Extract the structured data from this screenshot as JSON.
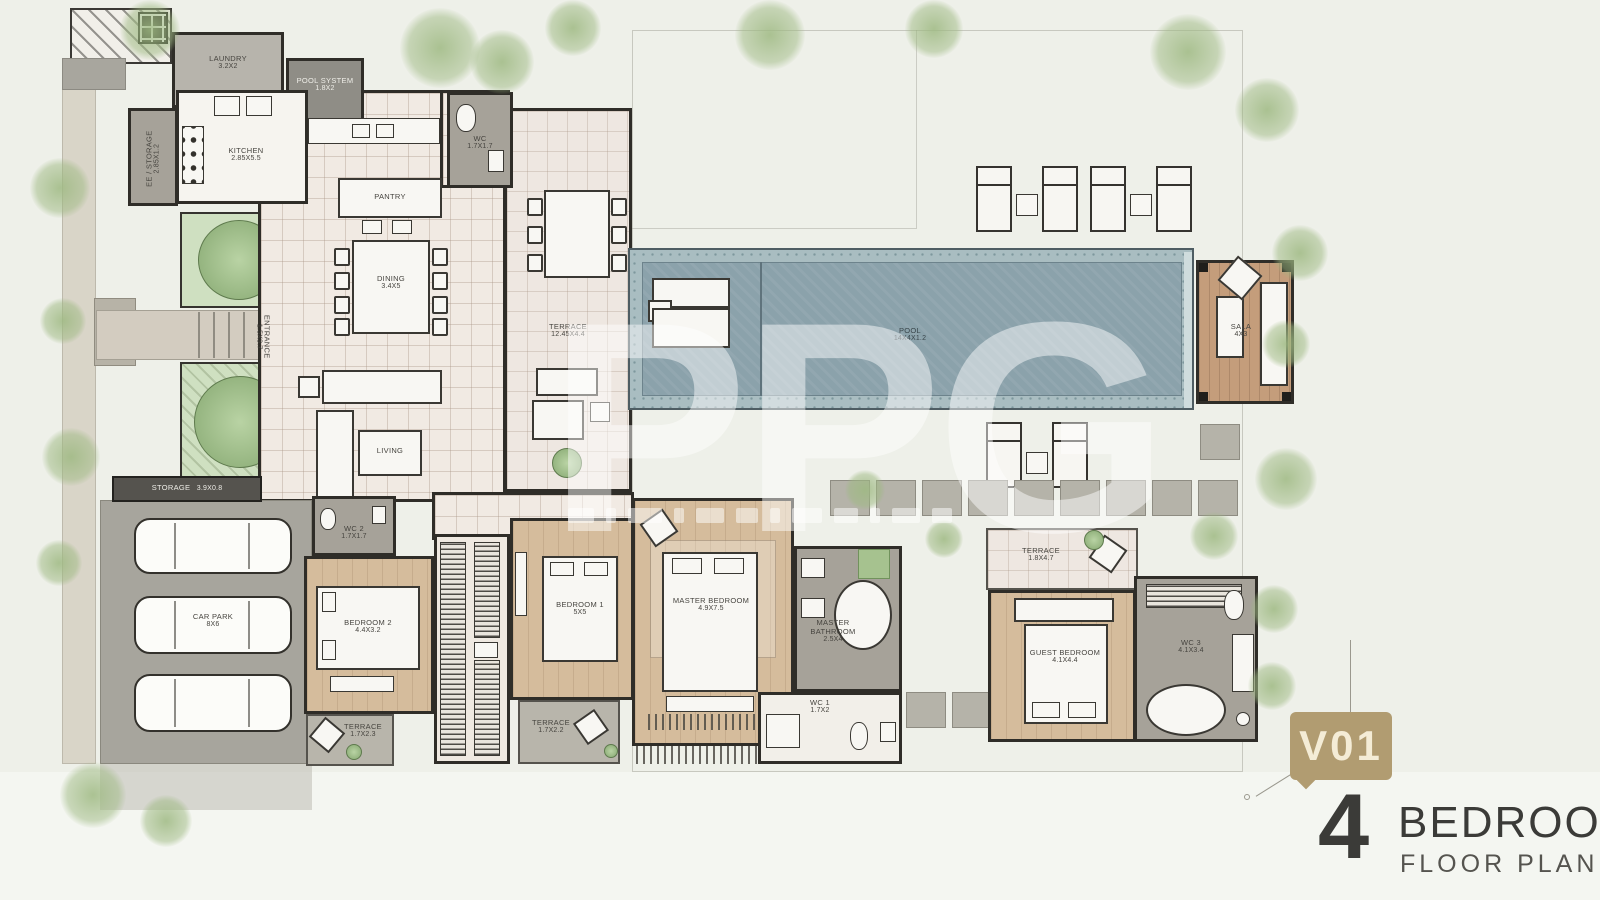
{
  "watermark": {
    "text": "PPG"
  },
  "title_block": {
    "badge": "V01",
    "number": "4",
    "title": "BEDROOM",
    "subtitle": "FLOOR PLAN",
    "badge_color": "#b19c71",
    "text_color": "#3b3b38"
  },
  "rooms": {
    "laundry": {
      "name": "LAUNDRY",
      "dims": "3.2x2"
    },
    "pool_system": {
      "name": "POOL SYSTEM",
      "dims": "1.8x2"
    },
    "ee_storage": {
      "name": "EE / STORAGE",
      "dims": "2.85x1.2"
    },
    "kitchen": {
      "name": "KITCHEN",
      "dims": "2.85x5.5"
    },
    "wc_top": {
      "name": "WC",
      "dims": "1.7x1.7"
    },
    "pantry": {
      "name": "PANTRY"
    },
    "dining": {
      "name": "DINING",
      "dims": "3.4x5"
    },
    "entrance": {
      "name": "ENTRANCE",
      "dims": "1.5x3.7"
    },
    "living": {
      "name": "LIVING"
    },
    "terrace_main": {
      "name": "TERRACE",
      "dims": "12.45x4.4"
    },
    "pool": {
      "name": "POOL",
      "dims": "14x4x1.2"
    },
    "sala": {
      "name": "SALA",
      "dims": "4x3"
    },
    "storage": {
      "name": "STORAGE",
      "dims": "3.9x0.8"
    },
    "car_park": {
      "name": "CAR PARK",
      "dims": "8x6"
    },
    "wc2": {
      "name": "WC 2",
      "dims": "1.7x1.7"
    },
    "bedroom2": {
      "name": "BEDROOM 2",
      "dims": "4.4x3.2"
    },
    "bedroom1": {
      "name": "BEDROOM 1",
      "dims": "5x5"
    },
    "master_bedroom": {
      "name": "MASTER BEDROOM",
      "dims": "4.9x7.5"
    },
    "master_bathroom": {
      "name": "MASTER BATHROOM",
      "dims": "2.5x4"
    },
    "wc1": {
      "name": "WC 1",
      "dims": "1.7x2"
    },
    "terrace_b2": {
      "name": "TERRACE",
      "dims": "1.7x2.3"
    },
    "terrace_b1": {
      "name": "TERRACE",
      "dims": "1.7x2.2"
    },
    "guest_terrace": {
      "name": "TERRACE",
      "dims": "1.8x4.7"
    },
    "guest_bedroom": {
      "name": "GUEST BEDROOM",
      "dims": "4.1x4.4"
    },
    "wc3": {
      "name": "WC 3",
      "dims": "4.1x3.4"
    }
  }
}
